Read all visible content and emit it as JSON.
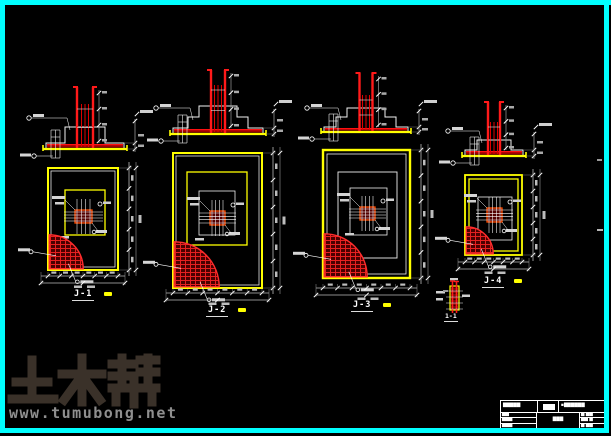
{
  "labels": {
    "j1": "J-1",
    "j2": "J-2",
    "j3": "J-3",
    "j4": "J-4",
    "detail": "1-1"
  },
  "watermark": {
    "logo": "土木帮",
    "url": "www.tumubong.net"
  },
  "colors": {
    "frame": "#00ffff",
    "line_yellow": "#ffff00",
    "line_red": "#ff1a1a",
    "fill_dark_red": "#9e0000",
    "line_white": "#f2f2f2",
    "dim_gray": "#9a9a9a",
    "watermark_logo": "#3a3129",
    "watermark_url": "#8f8f8f"
  },
  "title_block": {
    "row1_left": "▇▇▇▇▇",
    "row1_right": "▪▇▇▇▇▇▇",
    "left_rows": [
      "▇▇",
      "▇▇▇",
      "▇▇▇"
    ],
    "mid": "▇▇▇",
    "right_rows": [
      "▇ ▇▇",
      "▇▇ ▇",
      "▇ ▇▇"
    ]
  }
}
